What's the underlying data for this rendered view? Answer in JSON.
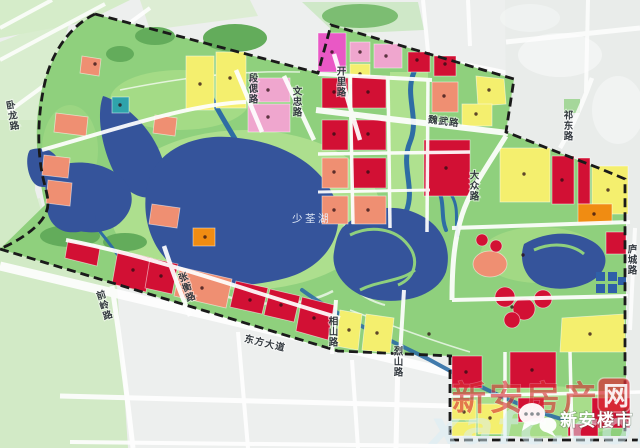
{
  "map": {
    "lake_label": "少荃湖",
    "road_labels": [
      {
        "id": "wolong",
        "text": "卧龙路"
      },
      {
        "id": "duansi",
        "text": "段偲路"
      },
      {
        "id": "wenzhong",
        "text": "文忠路"
      },
      {
        "id": "kaili",
        "text": "开里路"
      },
      {
        "id": "weiwu",
        "text": "魏武路"
      },
      {
        "id": "dazhong",
        "text": "大众路"
      },
      {
        "id": "qidong",
        "text": "祁东路"
      },
      {
        "id": "qianling",
        "text": "前岭路"
      },
      {
        "id": "zhangheng",
        "text": "张衡路"
      },
      {
        "id": "dongfang",
        "text": "东方大道"
      },
      {
        "id": "xiangshan",
        "text": "相山路"
      },
      {
        "id": "lieshan",
        "text": "烈山路"
      },
      {
        "id": "lucheng",
        "text": "庐城路"
      }
    ],
    "watermark": {
      "site_name_prefix": "新安房产",
      "site_name_suffix": "网",
      "brand_name": "新安楼市",
      "url_fragment": "xafc.com"
    },
    "colors": {
      "park_green": "#8fd07d",
      "water_blue": "#35549b",
      "stream_teal": "#2e6da4",
      "parcel_red": "#d21034",
      "parcel_salmon": "#ef8f72",
      "parcel_yellow": "#f4ef6e",
      "parcel_pink": "#efa6ce",
      "parcel_magenta": "#e958c5",
      "parcel_orange": "#f08c12",
      "parcel_teal": "#2fa3ab",
      "building_blue": "#2f5fa8",
      "boundary_black": "#1a1a1a",
      "road_white": "#ffffff",
      "watermark_red": "#d93036",
      "outside_gray": "#e9ecea",
      "field_green": "#d5ecc9"
    }
  }
}
